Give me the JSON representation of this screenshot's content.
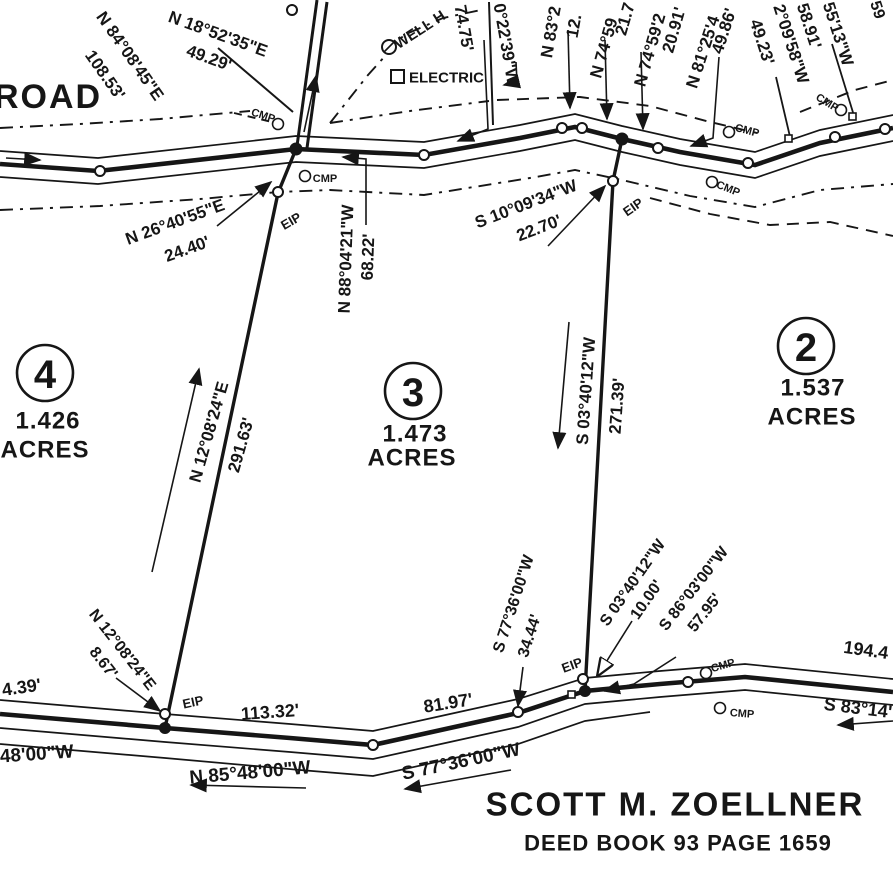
{
  "map": {
    "road_label": "ROAD",
    "owner_title": "SCOTT M. ZOELLNER",
    "owner_deed": "DEED BOOK 93 PAGE 1659",
    "ink_color": "#161616",
    "paper_color": "#ffffff",
    "monument_abbrevs": [
      "EIP",
      "CMP"
    ]
  },
  "lots": [
    {
      "number": "4",
      "acres": "1.426",
      "acres_word": "ACRES",
      "cx": 45,
      "cy": 373,
      "r": 28,
      "ax": 48,
      "ay": 421,
      "wx": 45,
      "wy": 450
    },
    {
      "number": "3",
      "acres": "1.473",
      "acres_word": "ACRES",
      "cx": 413,
      "cy": 391,
      "r": 28,
      "ax": 415,
      "ay": 434,
      "wx": 412,
      "wy": 458
    },
    {
      "number": "2",
      "acres": "1.537",
      "acres_word": "ACRES",
      "cx": 806,
      "cy": 346,
      "r": 28,
      "ax": 813,
      "ay": 388,
      "wx": 812,
      "wy": 417
    }
  ],
  "labels": [
    {
      "name": "road-name",
      "text": "ROAD",
      "x": 48,
      "y": 97,
      "rot": 0,
      "size": 34,
      "spacing": 2
    },
    {
      "name": "bearing-n84",
      "text": "N 84°08'45\"E",
      "x": 130,
      "y": 56,
      "rot": 55,
      "size": 17
    },
    {
      "name": "dist-n84",
      "text": "108.53'",
      "x": 105,
      "y": 75,
      "rot": 55,
      "size": 17
    },
    {
      "name": "bearing-n18",
      "text": "N 18°52'35\"E",
      "x": 218,
      "y": 34,
      "rot": 20,
      "size": 17
    },
    {
      "name": "dist-n18",
      "text": "49.29'",
      "x": 209,
      "y": 58,
      "rot": 20,
      "size": 17
    },
    {
      "name": "dist-7475",
      "text": "74.75'",
      "x": 464,
      "y": 28,
      "rot": 80,
      "size": 17
    },
    {
      "name": "bearing-022",
      "text": "0°22'39\"W",
      "x": 506,
      "y": 44,
      "rot": 80,
      "size": 17
    },
    {
      "name": "bearing-n83",
      "text": "N 83°2",
      "x": 551,
      "y": 32,
      "rot": -80,
      "size": 17
    },
    {
      "name": "dist-n83",
      "text": "12.",
      "x": 574,
      "y": 26,
      "rot": -80,
      "size": 17
    },
    {
      "name": "bearing-n74a",
      "text": "N 74°59",
      "x": 604,
      "y": 48,
      "rot": -74,
      "size": 17
    },
    {
      "name": "dist-n74a",
      "text": "21.7",
      "x": 625,
      "y": 19,
      "rot": -74,
      "size": 17
    },
    {
      "name": "bearing-n74b",
      "text": "N 74°59'2",
      "x": 650,
      "y": 50,
      "rot": -74,
      "size": 17
    },
    {
      "name": "dist-n74b",
      "text": "20.91'",
      "x": 674,
      "y": 30,
      "rot": -74,
      "size": 17
    },
    {
      "name": "bearing-n81",
      "text": "N 81°25'4",
      "x": 703,
      "y": 52,
      "rot": -72,
      "size": 17
    },
    {
      "name": "dist-n81",
      "text": "49.86'",
      "x": 724,
      "y": 31,
      "rot": -72,
      "size": 17
    },
    {
      "name": "dist-4923",
      "text": "49.23'",
      "x": 762,
      "y": 42,
      "rot": 72,
      "size": 17
    },
    {
      "name": "bearing-209",
      "text": "2°09'58\"W",
      "x": 791,
      "y": 44,
      "rot": 72,
      "size": 17
    },
    {
      "name": "dist-5891",
      "text": "58.91'",
      "x": 809,
      "y": 26,
      "rot": 72,
      "size": 17
    },
    {
      "name": "bearing-5513",
      "text": "55'13\"W",
      "x": 838,
      "y": 34,
      "rot": 72,
      "size": 17
    },
    {
      "name": "label-fragment",
      "text": "59",
      "x": 877,
      "y": 10,
      "rot": 72,
      "size": 16
    },
    {
      "name": "feature-well",
      "text": "WELL H",
      "x": 420,
      "y": 30,
      "rot": -33,
      "size": 15
    },
    {
      "name": "feature-electric",
      "text": "ELECTRIC",
      "x": 409,
      "y": 78,
      "rot": 0,
      "size": 15,
      "anchor": "start"
    },
    {
      "name": "bearing-n26",
      "text": "N 26°40'55\"E",
      "x": 175,
      "y": 222,
      "rot": -20,
      "size": 17
    },
    {
      "name": "dist-n26",
      "text": "24.40'",
      "x": 187,
      "y": 249,
      "rot": -20,
      "size": 17
    },
    {
      "name": "bearing-s10",
      "text": "S 10°09'34\"W",
      "x": 526,
      "y": 204,
      "rot": -21,
      "size": 17
    },
    {
      "name": "dist-s10",
      "text": "22.70'",
      "x": 539,
      "y": 228,
      "rot": -21,
      "size": 17
    },
    {
      "name": "bearing-n88",
      "text": "N 88°04'21\"W",
      "x": 346,
      "y": 259,
      "rot": -88,
      "size": 17
    },
    {
      "name": "dist-n88",
      "text": "68.22'",
      "x": 368,
      "y": 257,
      "rot": -88,
      "size": 17
    },
    {
      "name": "bearing-n12-main",
      "text": "N 12°08'24\"E",
      "x": 209,
      "y": 432,
      "rot": -74,
      "size": 17
    },
    {
      "name": "dist-n12-main",
      "text": "291.63'",
      "x": 241,
      "y": 445,
      "rot": -74,
      "size": 17
    },
    {
      "name": "bearing-s03-main",
      "text": "S 03°40'12\"W",
      "x": 586,
      "y": 391,
      "rot": -86,
      "size": 17
    },
    {
      "name": "dist-s03-main",
      "text": "271.39'",
      "x": 617,
      "y": 406,
      "rot": -86,
      "size": 17
    },
    {
      "name": "bearing-n12-small",
      "text": "N 12°08'24\"E",
      "x": 122,
      "y": 650,
      "rot": 52,
      "size": 16
    },
    {
      "name": "dist-n12-small",
      "text": "8.67'",
      "x": 103,
      "y": 663,
      "rot": 52,
      "size": 16
    },
    {
      "name": "bearing-s77-small",
      "text": "S 77°36'00\"W",
      "x": 514,
      "y": 604,
      "rot": -72,
      "size": 16
    },
    {
      "name": "dist-s77-small",
      "text": "34.44'",
      "x": 530,
      "y": 636,
      "rot": -72,
      "size": 16
    },
    {
      "name": "bearing-s03-small",
      "text": "S 03°40'12\"W",
      "x": 633,
      "y": 583,
      "rot": -55,
      "size": 16
    },
    {
      "name": "dist-s03-small",
      "text": "10.00'",
      "x": 647,
      "y": 600,
      "rot": -55,
      "size": 16
    },
    {
      "name": "bearing-s86",
      "text": "S 86°03'00\"W",
      "x": 694,
      "y": 589,
      "rot": -52,
      "size": 16
    },
    {
      "name": "dist-s86",
      "text": "57.95'",
      "x": 705,
      "y": 613,
      "rot": -52,
      "size": 16
    },
    {
      "name": "dist-11332",
      "text": "113.32'",
      "x": 270,
      "y": 712,
      "rot": -4,
      "size": 18
    },
    {
      "name": "dist-8197",
      "text": "81.97'",
      "x": 448,
      "y": 703,
      "rot": -9,
      "size": 18
    },
    {
      "name": "dist-439",
      "text": "4.39'",
      "x": 2,
      "y": 690,
      "rot": -8,
      "size": 18,
      "anchor": "start"
    },
    {
      "name": "bearing-n85",
      "text": "N 85°48'00\"W",
      "x": 250,
      "y": 773,
      "rot": -5,
      "size": 19
    },
    {
      "name": "bearing-partial-4800",
      "text": "48'00\"W",
      "x": 0,
      "y": 757,
      "rot": -4,
      "size": 19,
      "anchor": "start"
    },
    {
      "name": "bearing-s77-road",
      "text": "S 77°36'00\"W",
      "x": 461,
      "y": 762,
      "rot": -12,
      "size": 19
    },
    {
      "name": "dist-1944",
      "text": "194.4",
      "x": 866,
      "y": 650,
      "rot": 8,
      "size": 18
    },
    {
      "name": "bearing-s83",
      "text": "S 83°14'",
      "x": 858,
      "y": 708,
      "rot": 7,
      "size": 18
    },
    {
      "name": "owner-name",
      "text": "SCOTT M. ZOELLNER",
      "x": 675,
      "y": 804,
      "rot": 0,
      "size": 33,
      "spacing": 2
    },
    {
      "name": "deed-ref",
      "text": "DEED BOOK 93 PAGE 1659",
      "x": 678,
      "y": 843,
      "rot": 0,
      "size": 22,
      "spacing": 1
    },
    {
      "name": "eip-label",
      "text": "EIP",
      "x": 291,
      "y": 221,
      "rot": -30,
      "size": 13
    },
    {
      "name": "eip-label",
      "text": "EIP",
      "x": 633,
      "y": 207,
      "rot": -35,
      "size": 13
    },
    {
      "name": "eip-label",
      "text": "EIP",
      "x": 193,
      "y": 702,
      "rot": -12,
      "size": 13
    },
    {
      "name": "eip-label",
      "text": "EIP",
      "x": 572,
      "y": 665,
      "rot": -20,
      "size": 13
    },
    {
      "name": "cmp-label",
      "text": "CMP",
      "x": 263,
      "y": 116,
      "rot": 18,
      "size": 11
    },
    {
      "name": "cmp-label",
      "text": "CMP",
      "x": 325,
      "y": 179,
      "rot": 0,
      "size": 11
    },
    {
      "name": "cmp-label",
      "text": "CMP",
      "x": 728,
      "y": 189,
      "rot": 22,
      "size": 11
    },
    {
      "name": "cmp-label",
      "text": "CMP",
      "x": 747,
      "y": 131,
      "rot": 15,
      "size": 11
    },
    {
      "name": "cmp-label",
      "text": "CMP",
      "x": 827,
      "y": 103,
      "rot": 32,
      "size": 11
    },
    {
      "name": "cmp-label",
      "text": "CMP",
      "x": 723,
      "y": 666,
      "rot": -16,
      "size": 11
    },
    {
      "name": "cmp-label",
      "text": "CMP",
      "x": 742,
      "y": 714,
      "rot": 4,
      "size": 11
    }
  ]
}
